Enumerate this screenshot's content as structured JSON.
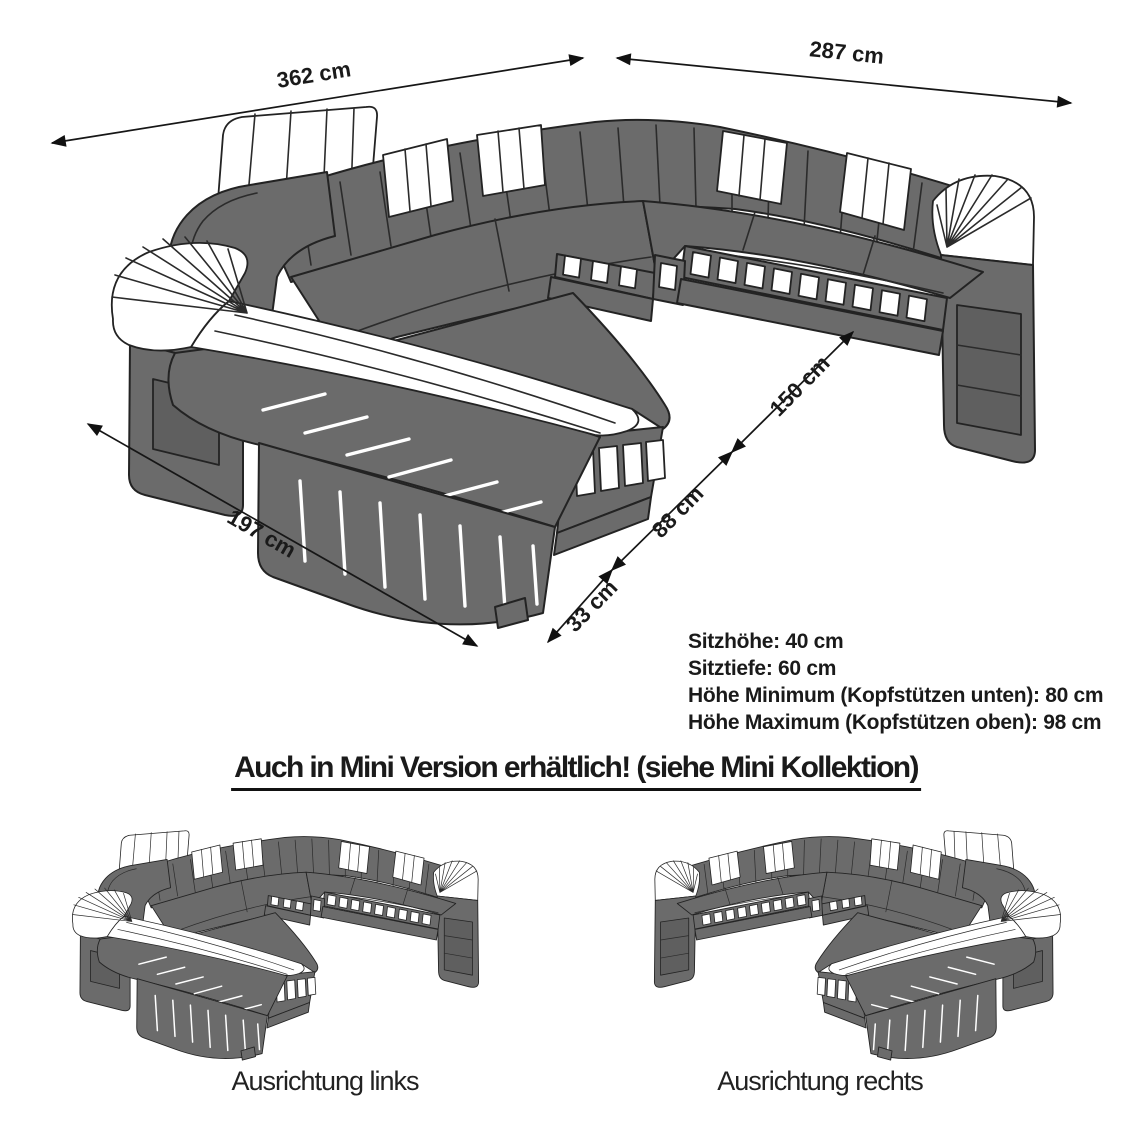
{
  "diagram": {
    "dimensions": {
      "back_left": {
        "label": "362 cm"
      },
      "back_right": {
        "label": "287 cm"
      },
      "chaise_side": {
        "label": "197 cm"
      },
      "depth_rear": {
        "label": "150 cm"
      },
      "depth_mid": {
        "label": "88 cm"
      },
      "depth_front": {
        "label": "33 cm"
      }
    },
    "specs": {
      "line1": "Sitzhöhe: 40 cm",
      "line2": "Sitztiefe: 60 cm",
      "line3": "Höhe Minimum (Kopfstützen unten): 80 cm",
      "line4": "Höhe Maximum (Kopfstützen oben): 98 cm"
    },
    "mini_heading": "Auch in Mini Version erhältlich! (siehe Mini Kollektion)",
    "variants": {
      "left": "Ausrichtung links",
      "right": "Ausrichtung rechts"
    },
    "colors": {
      "sofa_gray": "#6b6b6b",
      "outline": "#232323",
      "accent_white": "#ffffff",
      "background": "#ffffff"
    }
  }
}
